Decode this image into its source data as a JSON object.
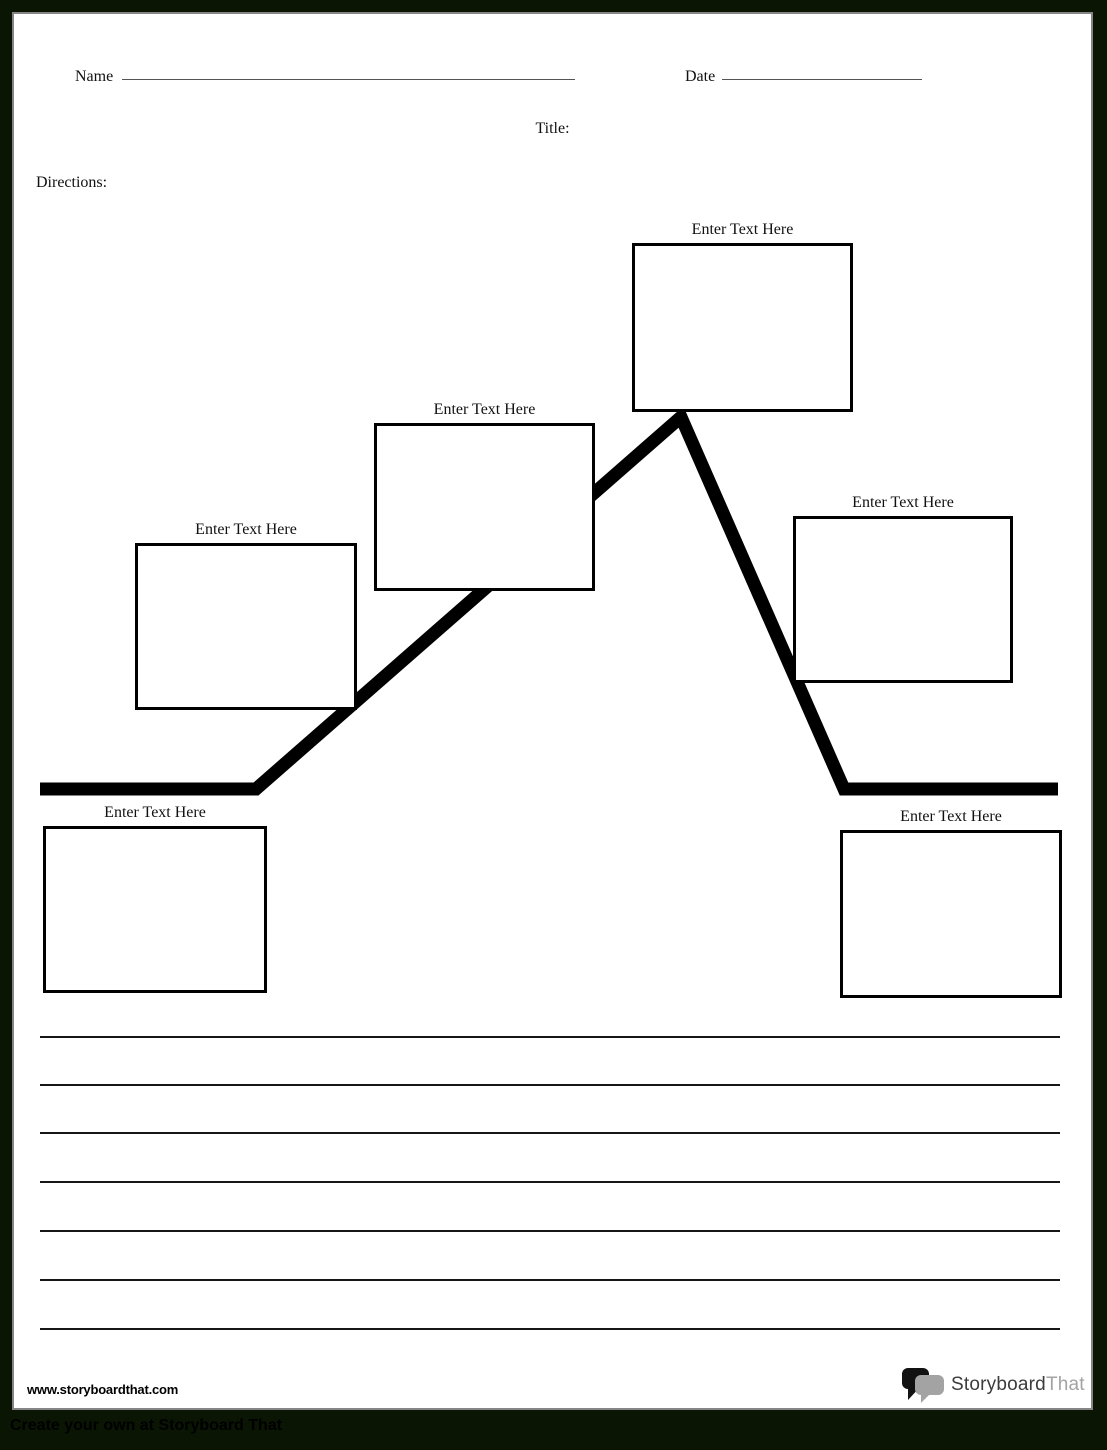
{
  "page": {
    "name_label": "Name",
    "date_label": "Date",
    "title_label": "Title:",
    "directions_label": "Directions:"
  },
  "plot_diagram": {
    "boxes": [
      {
        "label": "Enter Text Here"
      },
      {
        "label": "Enter Text Here"
      },
      {
        "label": "Enter Text Here"
      },
      {
        "label": "Enter Text Here"
      },
      {
        "label": "Enter Text Here"
      },
      {
        "label": "Enter Text Here"
      }
    ],
    "line_color": "#000000",
    "line_thickness_px": 13
  },
  "writing_lines_count": 7,
  "footer": {
    "website_url": "www.storyboardthat.com",
    "logo": {
      "icon": "speech-bubbles-icon",
      "primary": "Storyboard",
      "secondary": "That"
    },
    "tagline": "Create your own at Storyboard That"
  },
  "colors": {
    "frame_background": "#0a1504",
    "page_background": "#ffffff",
    "page_border_gray": "#858585",
    "ink": "#000000",
    "logo_primary": "#3c3c3c",
    "logo_secondary": "#a3a3a3"
  }
}
